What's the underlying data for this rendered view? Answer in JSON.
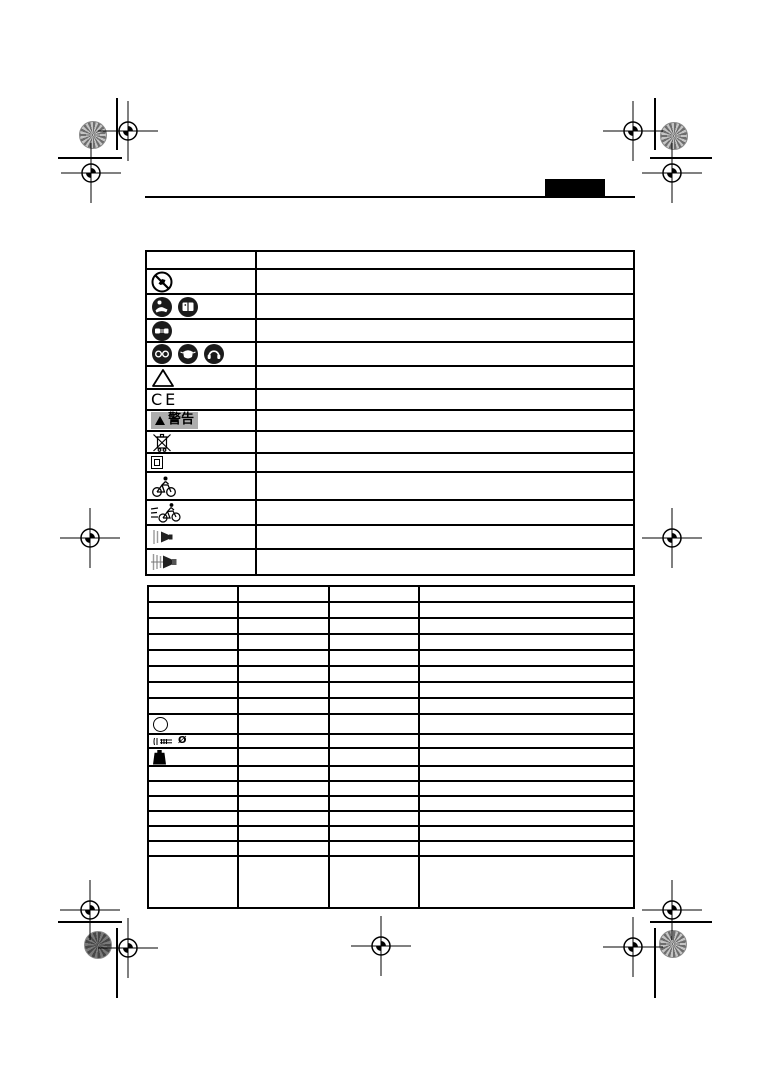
{
  "page": {
    "width": 765,
    "height": 1082,
    "background": "#ffffff"
  },
  "header": {
    "tab_color": "#000000",
    "rule_color": "#000000"
  },
  "print_marks": {
    "crosshair_icon": "registration-crosshair",
    "pinwheel_icon": "color-control-patch",
    "pinwheel_color": "#8a8a8a"
  },
  "symbols_table": {
    "rows": [
      {
        "icons": []
      },
      {
        "icons": [
          "no-reach-prohibition-icon"
        ]
      },
      {
        "icons": [
          "read-manual-icon",
          "instruction-book-icon"
        ]
      },
      {
        "icons": [
          "unplug-icon"
        ]
      },
      {
        "icons": [
          "eye-protection-icon",
          "dust-mask-icon",
          "ear-protection-icon"
        ]
      },
      {
        "icons": [
          "warning-triangle-icon"
        ]
      },
      {
        "icons": [
          "ce-mark"
        ],
        "text": "CE"
      },
      {
        "icons": [
          "warning-triangle-filled-icon"
        ],
        "text": "警告",
        "badge_bg": "#adadad"
      },
      {
        "icons": [
          "weee-crossed-bin-icon"
        ]
      },
      {
        "icons": [
          "double-insulation-icon"
        ]
      },
      {
        "icons": [
          "cyclist-icon"
        ]
      },
      {
        "icons": [
          "fast-cyclist-icon"
        ]
      },
      {
        "icons": [
          "speaker-low-icon"
        ]
      },
      {
        "icons": [
          "speaker-loud-icon"
        ]
      }
    ]
  },
  "spec_table": {
    "columns": 4,
    "rows": [
      {
        "icons": []
      },
      {
        "icons": []
      },
      {
        "icons": []
      },
      {
        "icons": []
      },
      {
        "icons": []
      },
      {
        "icons": []
      },
      {
        "icons": []
      },
      {
        "icons": []
      },
      {
        "icons": [
          "circle-symbol-icon"
        ]
      },
      {
        "icons": [
          "screw-icon",
          "diameter-symbol"
        ]
      },
      {
        "icons": [
          "weight-icon"
        ]
      },
      {
        "icons": []
      },
      {
        "icons": []
      },
      {
        "icons": []
      },
      {
        "icons": []
      },
      {
        "icons": []
      },
      {
        "icons": []
      },
      {
        "icons": []
      }
    ]
  },
  "glyphs": {
    "diameter": "Ø"
  }
}
